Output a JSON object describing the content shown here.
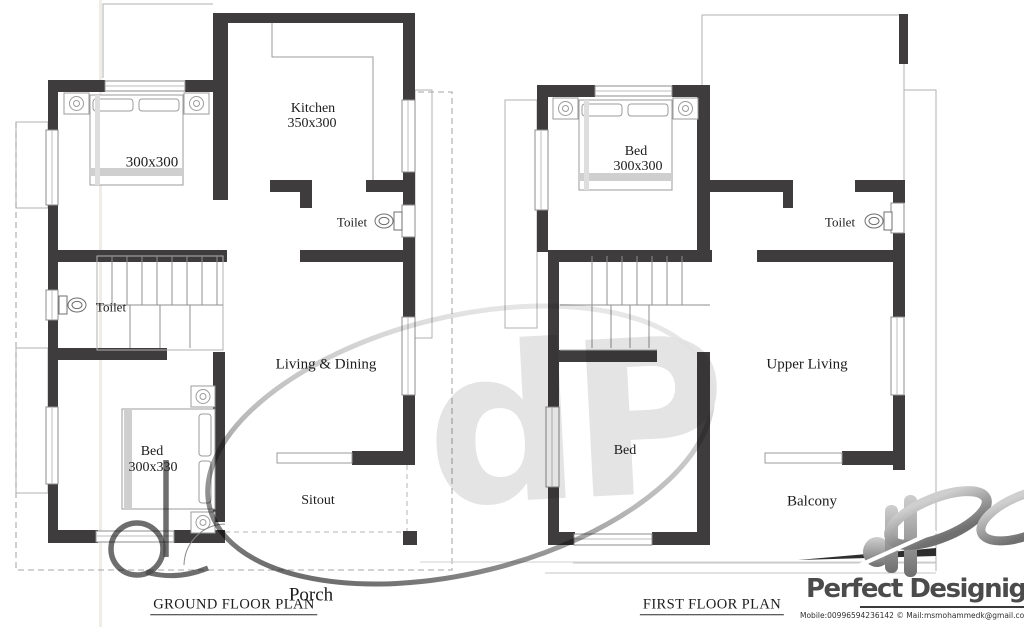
{
  "ground_floor": {
    "title": "GROUND FLOOR PLAN",
    "labels": {
      "kitchen": "Kitchen",
      "kitchen_size": "350x300",
      "bedroom_size": "300x300",
      "toilet_right": "Toilet",
      "toilet_left": "Toilet",
      "living_dining": "Living & Dining",
      "bed": "Bed",
      "bed_size": "300x330",
      "sitout": "Sitout",
      "porch": "Porch"
    }
  },
  "first_floor": {
    "title": "FIRST FLOOR PLAN",
    "labels": {
      "bed_top": "Bed",
      "bed_top_size": "300x300",
      "toilet": "Toilet",
      "upper_living": "Upper Living",
      "bed_bottom": "Bed",
      "balcony": "Balcony"
    }
  },
  "branding": {
    "name": "Perfect Designign",
    "contact": "Mobile:00996594236142 © Mail:msmohammedk@gmail.com",
    "contact_fragment": "gmail.com",
    "watermark_monogram": "dP"
  },
  "colors": {
    "wall": "#3f3c3d",
    "thin_line": "#9b9b9b",
    "dashed_line": "#b6b6b6",
    "label_text": "#1c1c1c",
    "brand_text": "#4b4b4b"
  }
}
